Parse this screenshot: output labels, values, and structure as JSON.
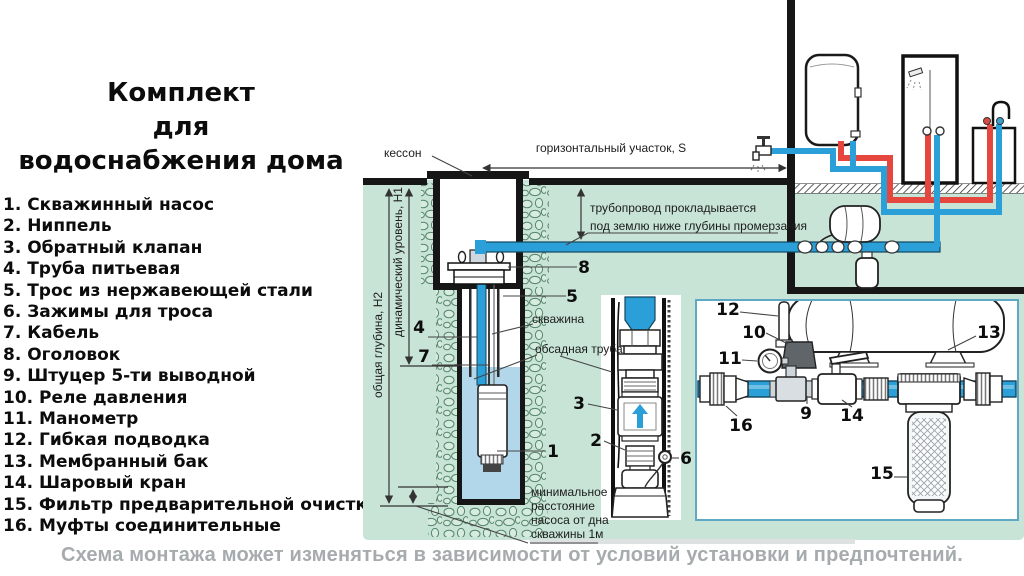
{
  "title": {
    "lines": [
      "Комплект",
      "для",
      "водоснабжения дома"
    ]
  },
  "parts_list": {
    "items": [
      "1. Скважинный насос",
      "2. Ниппель",
      "3. Обратный клапан",
      "4. Труба питьевая",
      "5. Трос из нержавеющей стали",
      "6. Зажимы для троса",
      "7. Кабель",
      "8. Оголовок",
      "9. Штуцер 5-ти выводной",
      "10. Реле давления",
      "11. Манометр",
      "12. Гибкая подводка",
      "13. Мембранный бак",
      "14. Шаровый кран",
      "15. Фильтр предварительной очистки",
      "16. Муфты соединительные"
    ]
  },
  "diagram": {
    "labels": {
      "kesson": "кессон",
      "horizontal_section": "горизонтальный участок, S",
      "pipe_note_line1": "трубопровод прокладывается",
      "pipe_note_line2": "под землю ниже глубины промерзания",
      "well": "скважина",
      "casing_pipe": "обсадная труба",
      "total_depth": "общая глубина, Н2",
      "dynamic_level": "динамический уровень, Н1",
      "min_dist_line1": "минимальное",
      "min_dist_line2": "расстояние",
      "min_dist_line3": "насоса от дна",
      "min_dist_line4": "скважины 1м"
    },
    "callouts": {
      "n1": "1",
      "n2": "2",
      "n3": "3",
      "n4": "4",
      "n5": "5",
      "n6": "6",
      "n7": "7",
      "n8": "8",
      "n9": "9",
      "n10": "10",
      "n11": "11",
      "n12": "12",
      "n13": "13",
      "n14": "14",
      "n15": "15",
      "n16": "16"
    },
    "colors": {
      "ground": "#c8e4d6",
      "cold_pipe": "#2ba0d8",
      "hot_pipe": "#e5473e",
      "water": "#b3d7ea",
      "panel_border": "#5fa9c5"
    }
  },
  "footer": {
    "note": "Схема монтажа может изменяться в зависимости от условий установки и предпочтений."
  }
}
